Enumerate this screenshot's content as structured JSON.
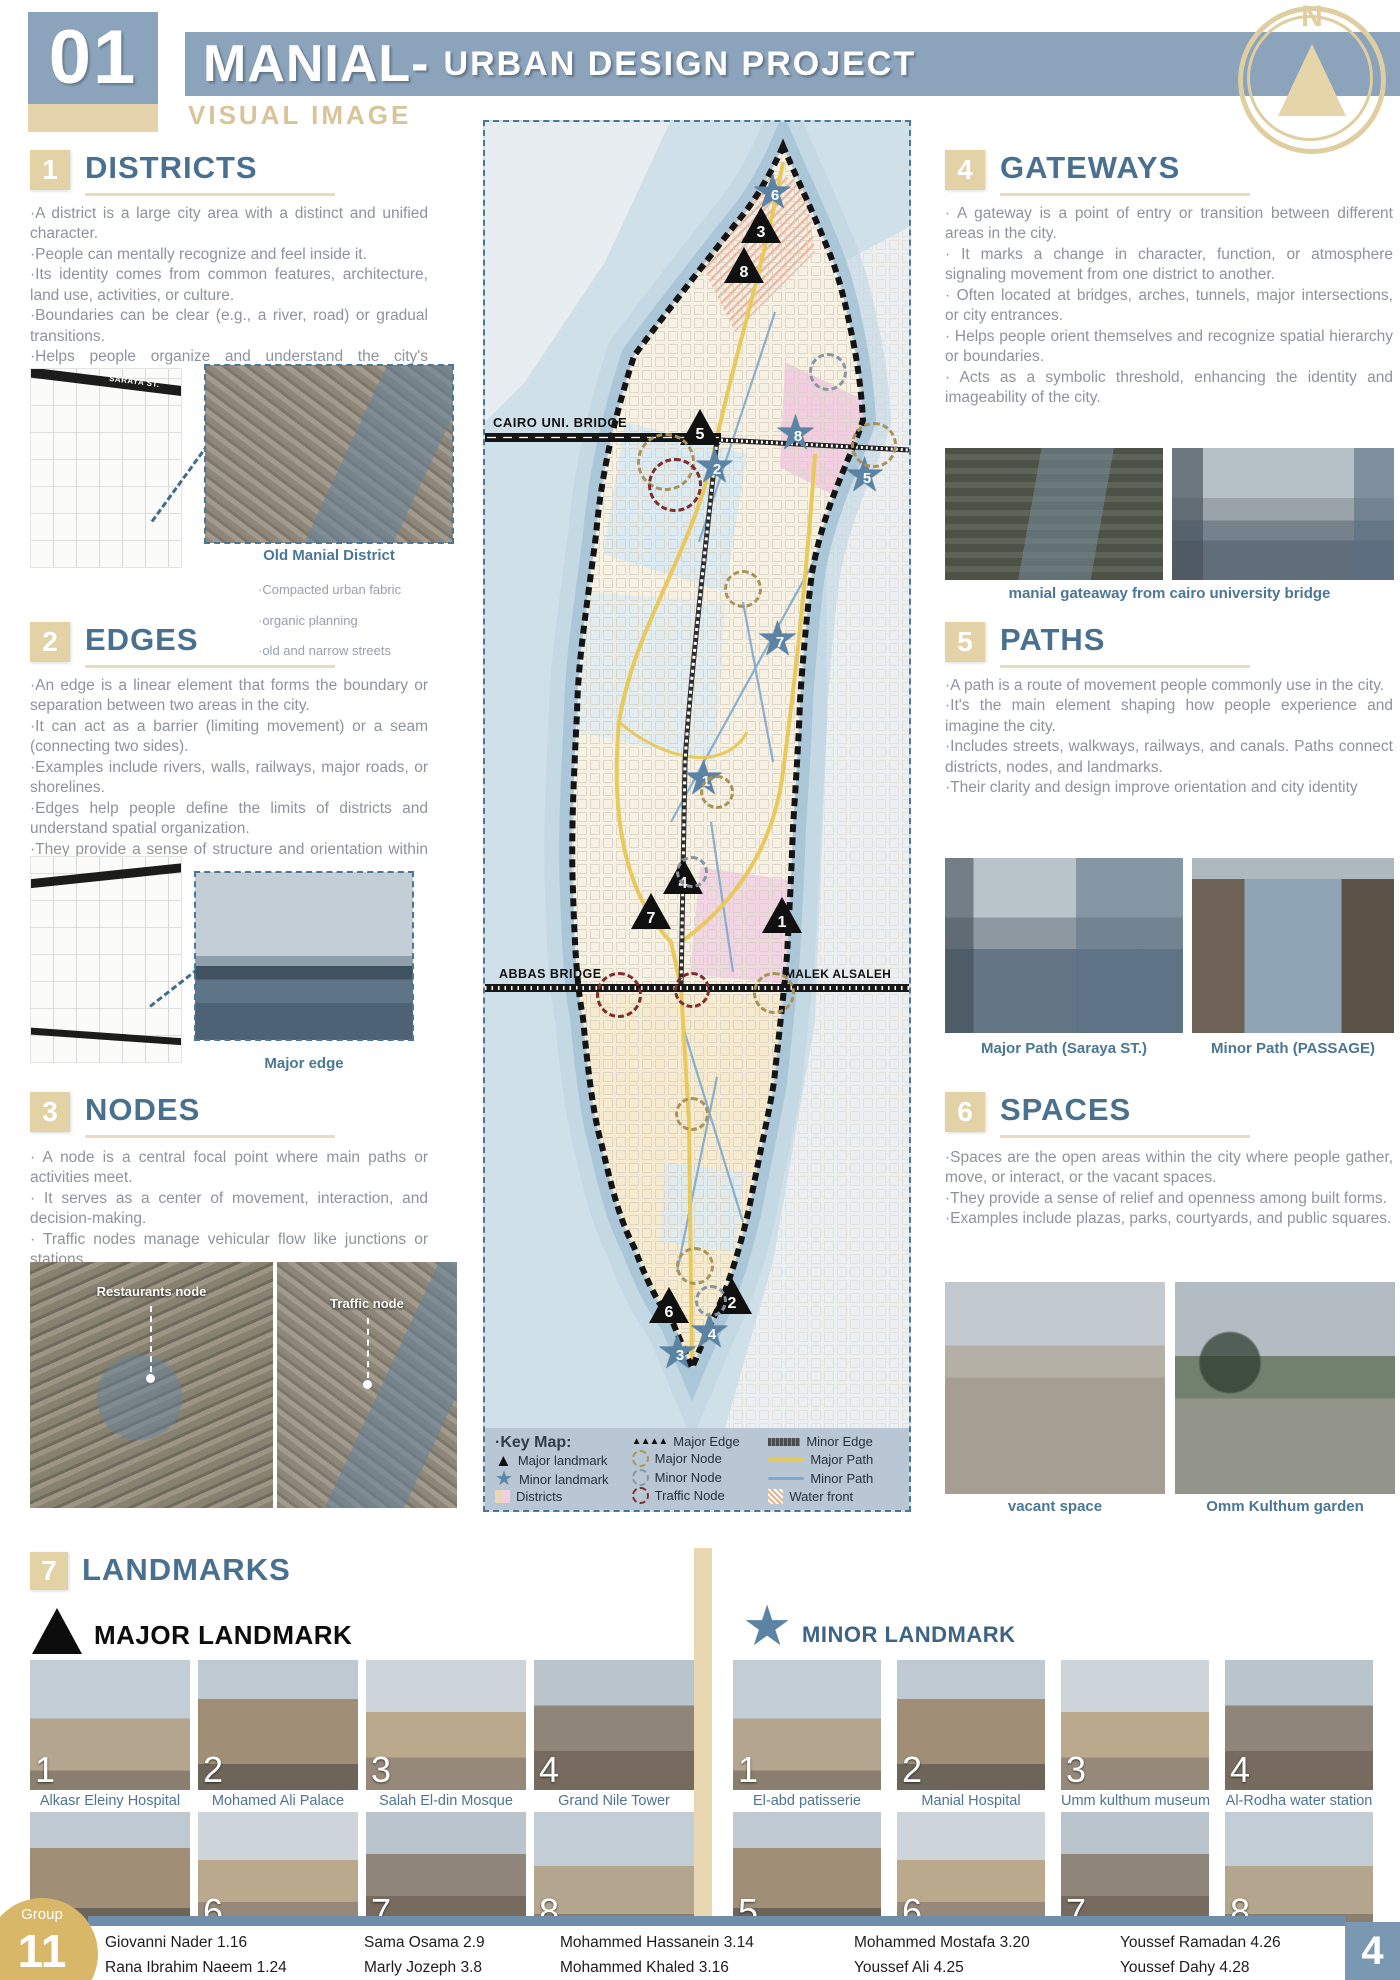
{
  "header": {
    "number": "01",
    "title": "MANIAL-",
    "subtitle": "URBAN DESIGN PROJECT",
    "tagline": "VISUAL IMAGE",
    "compass": "N"
  },
  "sections": {
    "districts": {
      "num": "1",
      "title": "DISTRICTS",
      "bullets": [
        "·A district is a large city area with a distinct and unified character.",
        "·People can mentally recognize and feel inside it.",
        "·Its identity comes from common features, architecture, land use, activities, or culture.",
        "·Boundaries can be clear (e.g., a river, road) or gradual transitions.",
        "·Helps people organize and understand the city's structure."
      ],
      "thumb_label": "SARAYA ST.",
      "caption": "Old Manial District",
      "notes": [
        "·Compacted urban  fabric",
        "·organic planning",
        "·old and narrow streets"
      ]
    },
    "edges": {
      "num": "2",
      "title": "EDGES",
      "bullets": [
        "·An edge is a linear element that forms the boundary or separation between two areas in the city.",
        "·It can act as a barrier (limiting movement) or a seam (connecting two sides).",
        "·Examples include rivers, walls, railways, major roads, or shorelines.",
        "·Edges help people define the limits of districts and understand spatial organization.",
        "·They provide a sense of structure and orientation within the urban landscape."
      ],
      "caption": "Major edge"
    },
    "nodes": {
      "num": "3",
      "title": "NODES",
      "bullets": [
        "· A node is a central focal point where main paths or activities meet.",
        "· It serves as a center of movement, interaction, and decision-making.",
        "· Traffic nodes manage vehicular flow like junctions or stations."
      ],
      "photo_labels": [
        "Restaurants node",
        "Traffic node"
      ]
    },
    "gateways": {
      "num": "4",
      "title": "GATEWAYS",
      "bullets": [
        "· A gateway is a point of entry or transition between different areas in the city.",
        "· It marks a change in character, function, or atmosphere signaling movement from one district to another.",
        "· Often located at bridges, arches, tunnels, major intersections, or city entrances.",
        "· Helps people orient themselves and recognize spatial hierarchy or boundaries.",
        "· Acts as a symbolic threshold, enhancing the identity and imageability of the city."
      ],
      "caption": "manial gateaway from cairo university bridge"
    },
    "paths": {
      "num": "5",
      "title": "PATHS",
      "bullets": [
        "·A path is a route of movement people commonly use in the city.",
        "·It's the main element shaping how people experience and imagine the city.",
        "·Includes streets, walkways, railways, and canals. Paths connect districts, nodes, and landmarks.",
        "·Their clarity and design improve orientation and city identity"
      ],
      "captions": [
        "Major Path (Saraya ST.)",
        "Minor Path (PASSAGE)"
      ]
    },
    "spaces": {
      "num": "6",
      "title": "SPACES",
      "bullets": [
        "·Spaces are the open areas within the city where people gather, move, or interact, or the vacant spaces.",
        "·They provide a sense of relief and openness among built forms.",
        "·Examples include plazas, parks, courtyards, and public squares."
      ],
      "captions": [
        "vacant space",
        "Omm Kulthum garden"
      ]
    }
  },
  "map": {
    "bridge_labels": [
      "CAIRO UNI. BRIDGE",
      "ABBAS BRIDGE",
      "MALEK ALSALEH"
    ],
    "markers": [
      {
        "t": "star",
        "n": "6",
        "x": 290,
        "y": 77
      },
      {
        "t": "tri",
        "n": "3",
        "x": 276,
        "y": 103
      },
      {
        "t": "tri",
        "n": "8",
        "x": 259,
        "y": 143
      },
      {
        "t": "tri",
        "n": "5",
        "x": 215,
        "y": 305
      },
      {
        "t": "star",
        "n": "2",
        "x": 232,
        "y": 351
      },
      {
        "t": "star",
        "n": "8",
        "x": 313,
        "y": 318
      },
      {
        "t": "star",
        "n": "5",
        "x": 382,
        "y": 360
      },
      {
        "t": "star",
        "n": "7",
        "x": 295,
        "y": 524
      },
      {
        "t": "star",
        "n": "1",
        "x": 221,
        "y": 663
      },
      {
        "t": "tri",
        "n": "4",
        "x": 198,
        "y": 754
      },
      {
        "t": "tri",
        "n": "7",
        "x": 166,
        "y": 789
      },
      {
        "t": "tri",
        "n": "1",
        "x": 297,
        "y": 793
      },
      {
        "t": "tri",
        "n": "6",
        "x": 184,
        "y": 1183
      },
      {
        "t": "tri",
        "n": "2",
        "x": 247,
        "y": 1174
      },
      {
        "t": "star",
        "n": "4",
        "x": 227,
        "y": 1216
      },
      {
        "t": "star",
        "n": "3",
        "x": 195,
        "y": 1237
      }
    ],
    "nodes": [
      {
        "c": "major",
        "x": 181,
        "y": 340,
        "r": 26
      },
      {
        "c": "major",
        "x": 389,
        "y": 323,
        "r": 20
      },
      {
        "c": "major",
        "x": 258,
        "y": 467,
        "r": 16
      },
      {
        "c": "major",
        "x": 232,
        "y": 670,
        "r": 14
      },
      {
        "c": "major",
        "x": 289,
        "y": 871,
        "r": 18
      },
      {
        "c": "major",
        "x": 207,
        "y": 992,
        "r": 14
      },
      {
        "c": "major",
        "x": 210,
        "y": 1144,
        "r": 16
      },
      {
        "c": "minor",
        "x": 343,
        "y": 250,
        "r": 16
      },
      {
        "c": "minor",
        "x": 207,
        "y": 750,
        "r": 13
      },
      {
        "c": "minor",
        "x": 226,
        "y": 1179,
        "r": 13
      },
      {
        "c": "traffic",
        "x": 190,
        "y": 363,
        "r": 24
      },
      {
        "c": "traffic",
        "x": 134,
        "y": 873,
        "r": 20
      },
      {
        "c": "traffic",
        "x": 207,
        "y": 868,
        "r": 15
      }
    ],
    "legend": {
      "title": "·Key Map:",
      "col1": [
        {
          "icon": "major-landmark",
          "label": "Major landmark"
        },
        {
          "icon": "minor-landmark",
          "label": "Minor landmark"
        },
        {
          "icon": "districts",
          "label": "Districts"
        }
      ],
      "col2": [
        {
          "icon": "major-edge",
          "label": "Major Edge"
        },
        {
          "icon": "major-node",
          "label": "Major Node"
        },
        {
          "icon": "minor-node",
          "label": "Minor Node"
        },
        {
          "icon": "traffic-node",
          "label": "Traffic Node"
        }
      ],
      "col3": [
        {
          "icon": "minor-edge",
          "label": "Minor Edge"
        },
        {
          "icon": "major-path",
          "label": "Major Path"
        },
        {
          "icon": "minor-path",
          "label": "Minor Path"
        },
        {
          "icon": "water-front",
          "label": "Water front"
        }
      ]
    }
  },
  "landmarks": {
    "num": "7",
    "title": "LANDMARKS",
    "major": {
      "heading": "MAJOR LANDMARK",
      "items": [
        {
          "n": "1",
          "label": "Alkasr Eleiny Hospital"
        },
        {
          "n": "2",
          "label": "Mohamed Ali Palace"
        },
        {
          "n": "3",
          "label": "Salah El-din Mosque"
        },
        {
          "n": "4",
          "label": "Grand Nile Tower"
        },
        {
          "n": "5",
          "label": "Minesterly Palace"
        },
        {
          "n": "6",
          "label": "Qaitbay Mosque"
        },
        {
          "n": "7",
          "label": "Nilometer"
        },
        {
          "n": "8",
          "label": "Faculty of dentistry"
        }
      ]
    },
    "minor": {
      "heading": "MINOR LANDMARK",
      "items": [
        {
          "n": "1",
          "label": "El-abd patisserie"
        },
        {
          "n": "2",
          "label": "Manial Hospital"
        },
        {
          "n": "3",
          "label": "Umm kulthum museum"
        },
        {
          "n": "4",
          "label": "Al-Rodha water station"
        },
        {
          "n": "5",
          "label": "Galleria mall cinema"
        },
        {
          "n": "6",
          "label": "Galaxy cinema"
        },
        {
          "n": "7",
          "label": "McDonald's"
        },
        {
          "n": "8",
          "label": "Faculty of tourism"
        }
      ]
    }
  },
  "footer": {
    "group_label": "Group",
    "group_number": "11",
    "page_number": "4",
    "members_row1": [
      "Giovanni Nader 1.16",
      "Sama Osama 2.9",
      "Mohammed Hassanein 3.14",
      "Mohammed Mostafa 3.20",
      "Youssef Ramadan 4.26"
    ],
    "members_row2": [
      "Rana Ibrahim Naeem 1.24",
      "Marly Jozeph 3.8",
      "Mohammed Khaled 3.16",
      "Youssef Ali 4.25",
      "Youssef Dahy 4.28"
    ]
  }
}
